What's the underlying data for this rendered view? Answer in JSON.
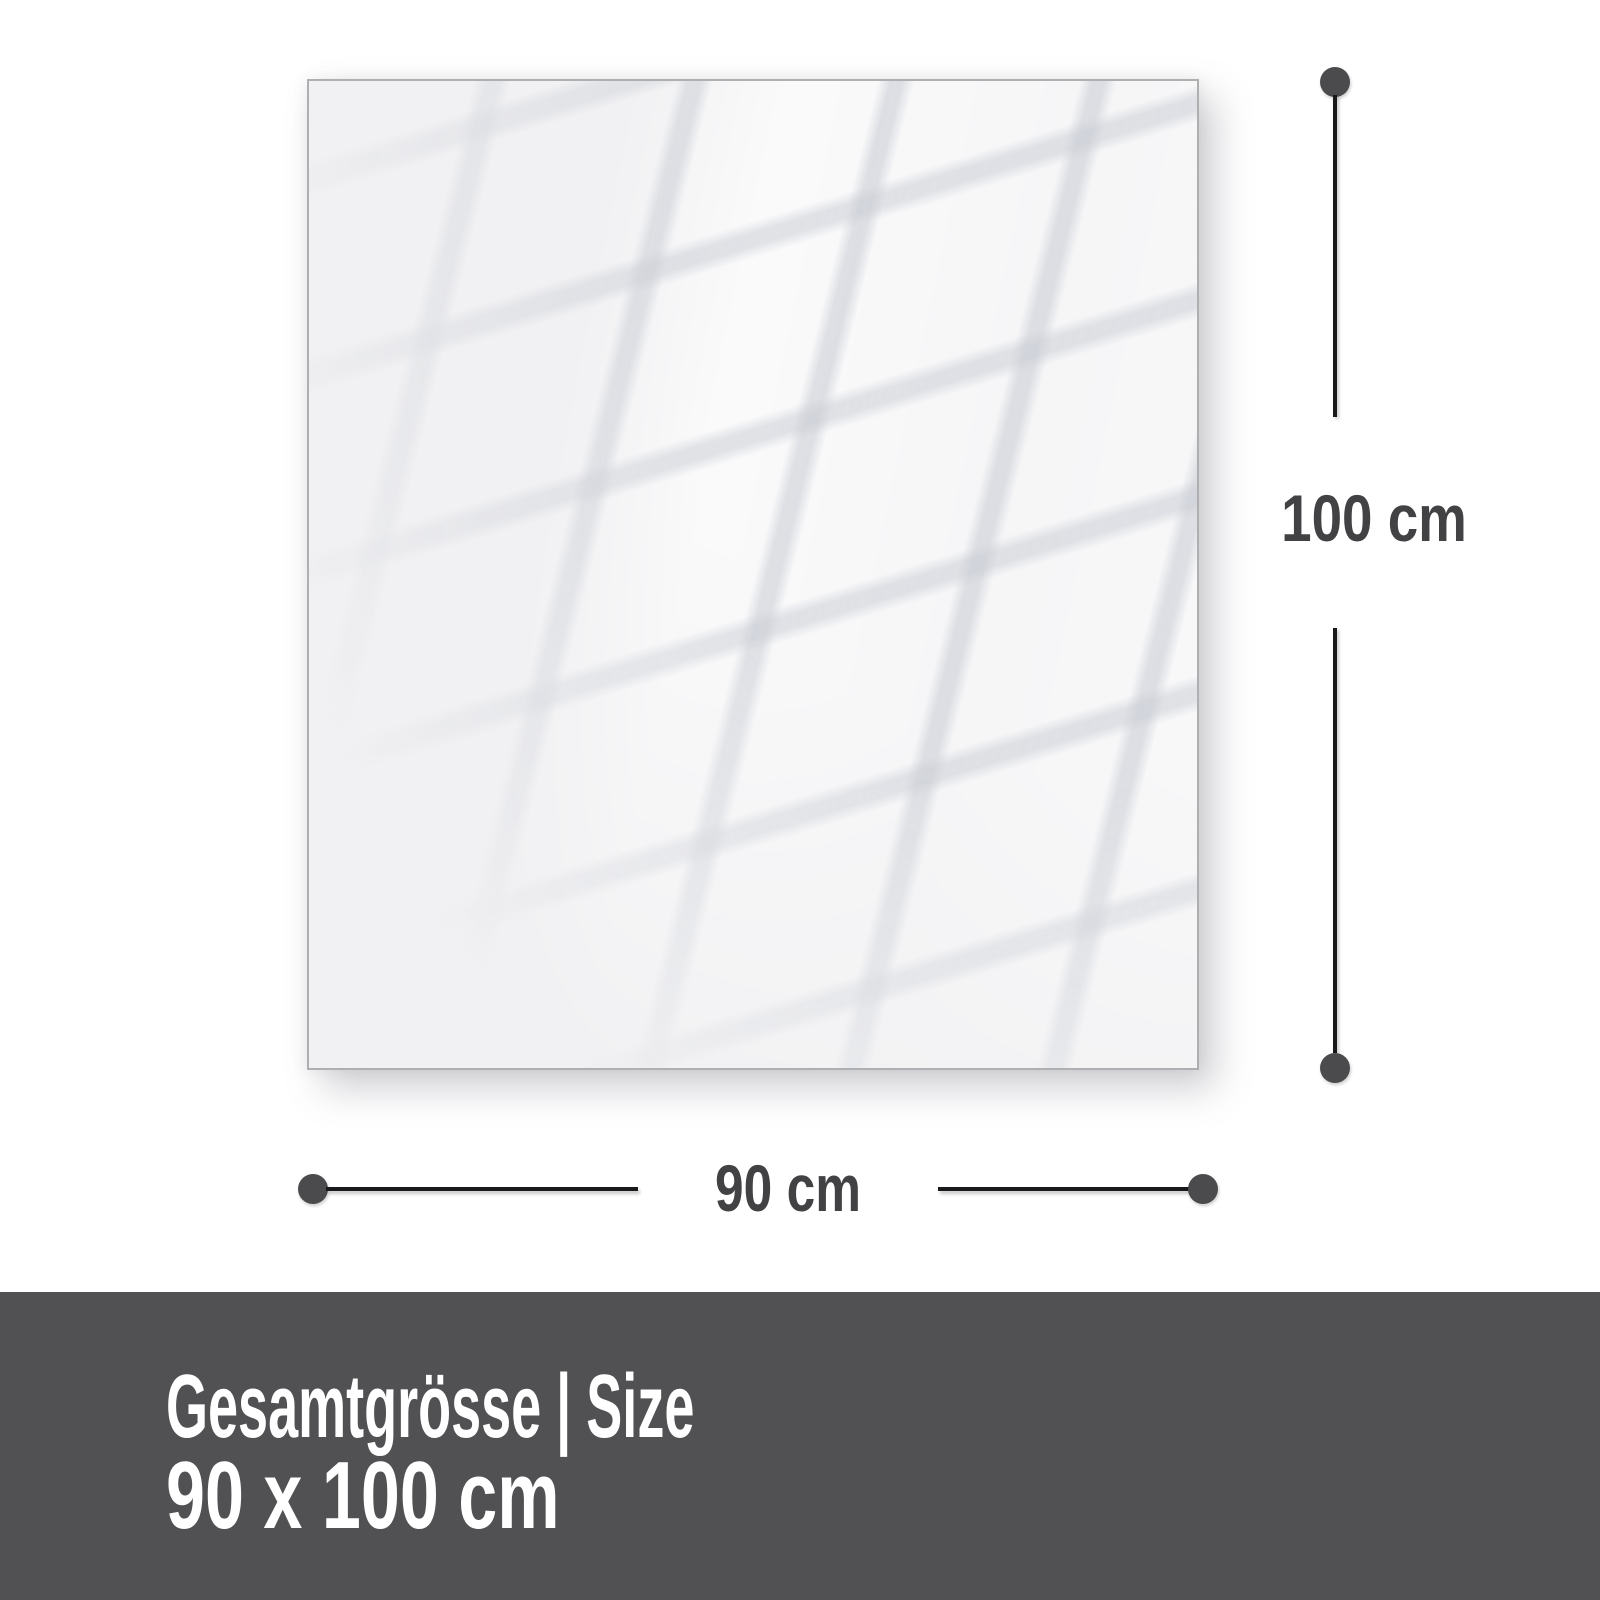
{
  "diagram": {
    "height_label": "100 cm",
    "width_label": "90 cm"
  },
  "footer": {
    "title": "Gesamtgrösse | Size",
    "size": "90 x 100 cm"
  },
  "colors": {
    "panel-bg": "#f1f1f3",
    "panel-border": "#aeafb1",
    "line": "#19191c",
    "dot": "#4b4b4d",
    "label-text": "#424245",
    "footer-bg": "#515153",
    "footer-text": "#ffffff"
  }
}
